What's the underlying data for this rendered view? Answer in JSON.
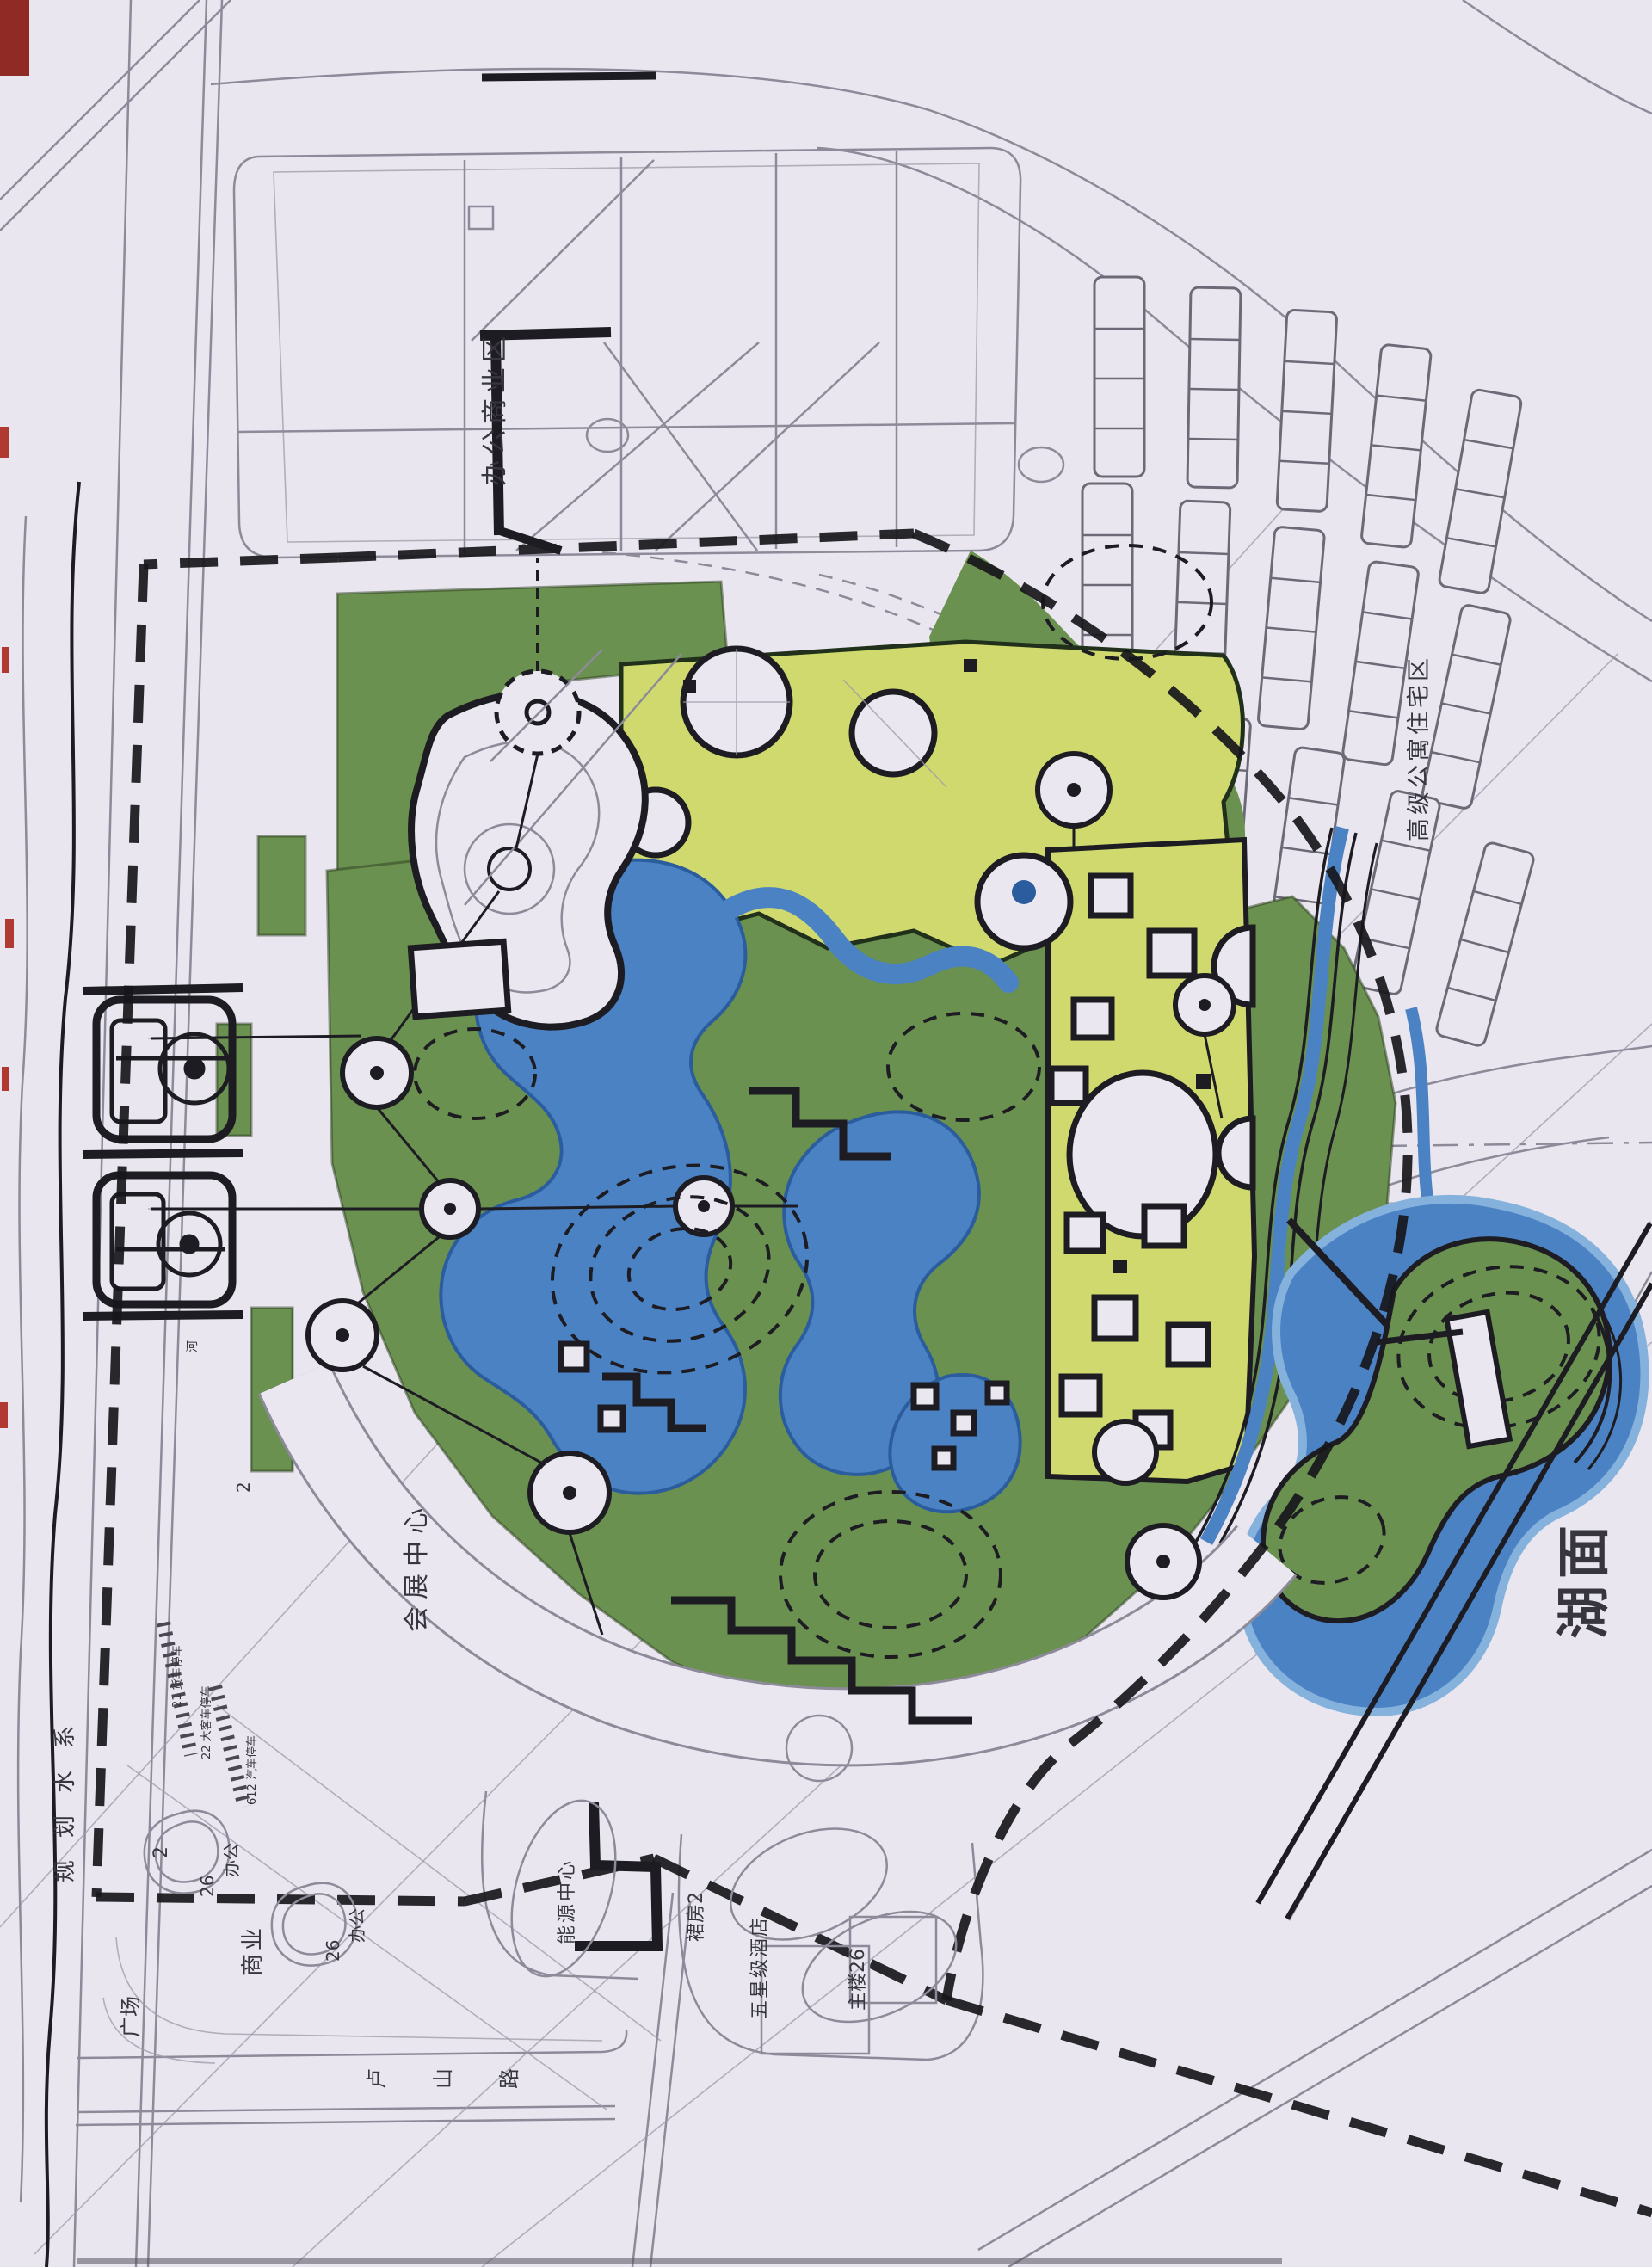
{
  "drawing": {
    "kind": "hand-drawn park master plan scan",
    "palette": {
      "paper": "#e9e6ef",
      "park_green": "#6b9150",
      "zone_yellow": "#cfd96e",
      "water_blue": "#4b82c4",
      "water_edge": "#2b5d9e",
      "ink": "#1d1c22",
      "pencil": "#8d8a99",
      "red_mark": "#8f2a24"
    }
  },
  "labels": {
    "office_commercial_district": "办公商业区",
    "premium_apartment_district": "高级公寓住宅区",
    "lake_surface": "湖面",
    "exhibition_center": "会展中心",
    "planned_water_system": "规划水系",
    "commercial": "商业",
    "plaza": "广场",
    "lushan_road": "卢山路",
    "office_26_a_num": "26",
    "office_26_a_text": "办公",
    "office_26_b_num": "26",
    "office_26_b_text": "办公",
    "lot_2_a": "2",
    "lot_2_b": "2",
    "energy_center": "能源中心",
    "hotel_podium": "裙房2",
    "five_star_hotel": "五星级酒店",
    "main_tower": "主楼26",
    "parking_trucks": "21 货车停车",
    "parking_buses": "22 大客车停车",
    "parking_cars": "612 汽车停车",
    "river": "河"
  }
}
